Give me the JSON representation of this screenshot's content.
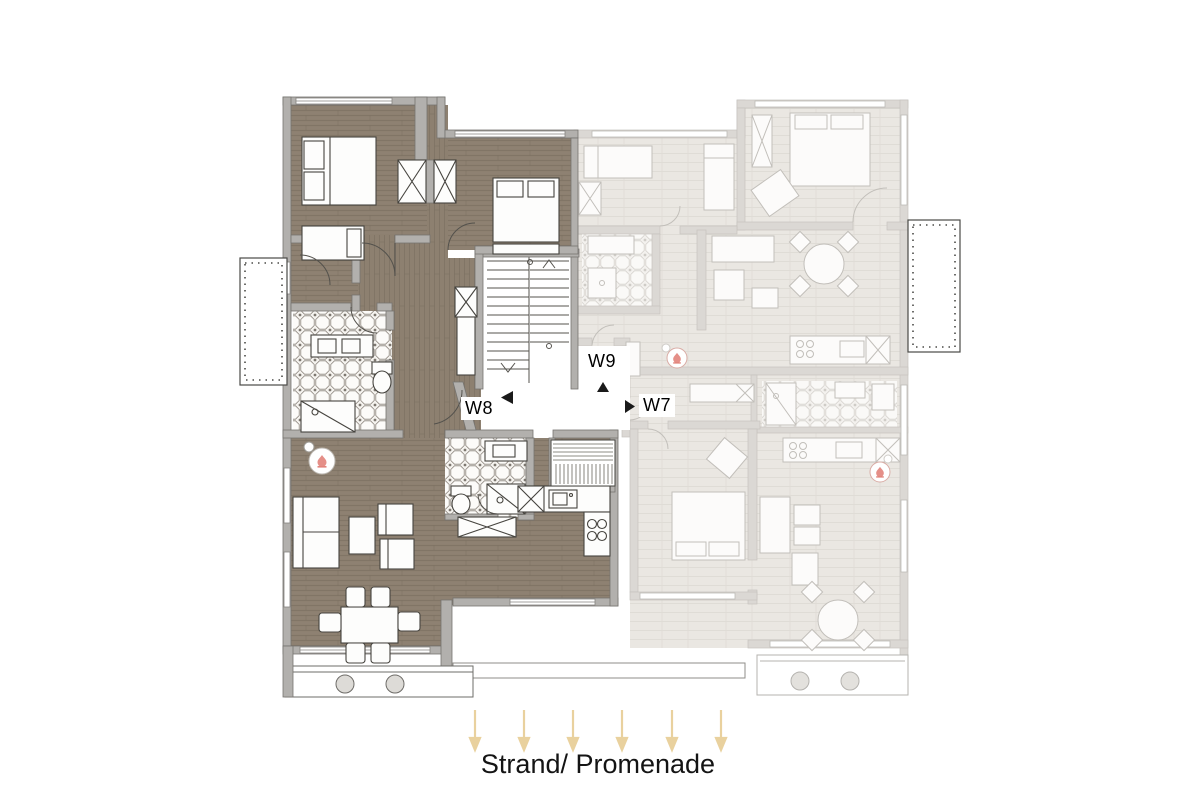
{
  "apartments": [
    {
      "id": "W8",
      "label": "W8",
      "state": "selected"
    },
    {
      "id": "W9",
      "label": "W9",
      "state": "unselected"
    },
    {
      "id": "W7",
      "label": "W7",
      "state": "unselected"
    }
  ],
  "legend": {
    "caption": "Strand/ Promenade",
    "arrow_count": 6
  },
  "colors": {
    "background": "#ffffff",
    "wood-floor": "#8d8070",
    "wall": "#b2b0ad",
    "faded-floor": "#eae7e2",
    "faded-wall": "#dbd8d4",
    "arrow": "#e9d19e",
    "fireplace": "#e2837b",
    "label-text": "#000000"
  },
  "icons": {
    "fireplace": "circle-with-flame",
    "direction-arrow": "down-arrow",
    "entry-marker": "solid-triangle",
    "stairs": "stepped-lines"
  }
}
